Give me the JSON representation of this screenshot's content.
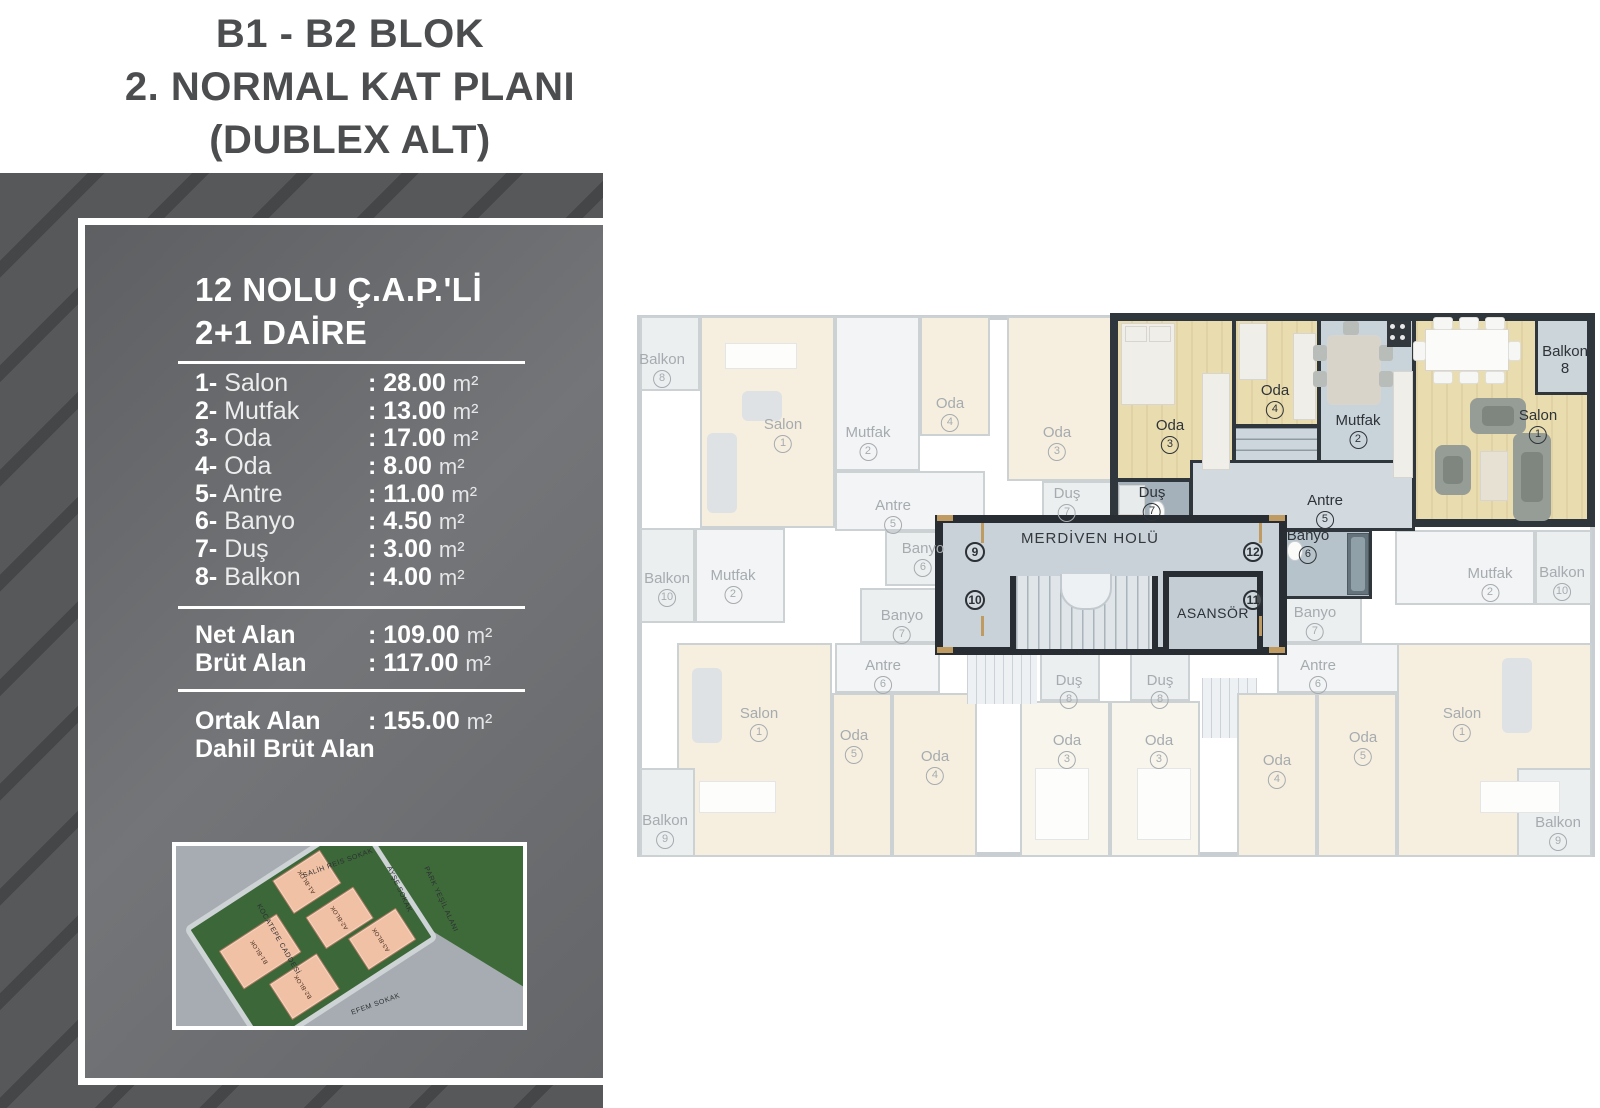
{
  "title": {
    "lines": [
      "B1 - B2 BLOK",
      "2. NORMAL KAT PLANI",
      "(DUBLEX ALT)"
    ]
  },
  "panel": {
    "heading_line1": "12 NOLU Ç.A.P.'Lİ",
    "heading_line2": "2+1 DAİRE",
    "rooms": [
      {
        "no": "1-",
        "name": "Salon",
        "value": ": 28.00",
        "unit": "m²"
      },
      {
        "no": "2-",
        "name": "Mutfak",
        "value": ": 13.00",
        "unit": "m²"
      },
      {
        "no": "3-",
        "name": "Oda",
        "value": ": 17.00",
        "unit": "m²"
      },
      {
        "no": "4-",
        "name": "Oda",
        "value": ": 8.00",
        "unit": "m²"
      },
      {
        "no": "5-",
        "name": "Antre",
        "value": ": 11.00",
        "unit": "m²"
      },
      {
        "no": "6-",
        "name": "Banyo",
        "value": ": 4.50",
        "unit": "m²"
      },
      {
        "no": "7-",
        "name": "Duş",
        "value": ": 3.00",
        "unit": "m²"
      },
      {
        "no": "8-",
        "name": "Balkon",
        "value": ": 4.00",
        "unit": "m²"
      }
    ],
    "areas": [
      {
        "label": "Net Alan",
        "value": ": 109.00",
        "unit": "m²"
      },
      {
        "label": "Brüt Alan",
        "value": ": 117.00",
        "unit": "m²"
      }
    ],
    "common_area": {
      "label_line1": "Ortak Alan",
      "label_line2": "Dahil Brüt Alan",
      "value": ": 155.00",
      "unit": "m²"
    }
  },
  "floor_plan": {
    "core": {
      "hall": "MERDİVEN HOLÜ",
      "elevator": "ASANSÖR",
      "numbers": [
        {
          "t": "9",
          "x": 338,
          "y": 239
        },
        {
          "t": "10",
          "x": 338,
          "y": 287
        },
        {
          "t": "12",
          "x": 616,
          "y": 239
        },
        {
          "t": "11",
          "x": 616,
          "y": 287
        }
      ]
    },
    "labels": [
      {
        "name": "Oda",
        "num": "3",
        "x": 533,
        "y": 104,
        "hl": true
      },
      {
        "name": "Oda",
        "num": "4",
        "x": 638,
        "y": 69,
        "hl": true
      },
      {
        "name": "Mutfak",
        "num": "2",
        "x": 721,
        "y": 99,
        "hl": true
      },
      {
        "name": "Salon",
        "num": "1",
        "x": 901,
        "y": 94,
        "hl": true
      },
      {
        "name": "Balkon",
        "num": "8",
        "x": 928,
        "y": 30,
        "hl": true,
        "plain": true
      },
      {
        "name": "Duş",
        "num": "7",
        "x": 515,
        "y": 171,
        "hl": true
      },
      {
        "name": "Antre",
        "num": "5",
        "x": 688,
        "y": 179,
        "hl": true
      },
      {
        "name": "Banyo",
        "num": "6",
        "x": 671,
        "y": 214,
        "hl": true
      },
      {
        "name": "Balkon",
        "num": "8",
        "x": 25,
        "y": 38
      },
      {
        "name": "Salon",
        "num": "1",
        "x": 146,
        "y": 103
      },
      {
        "name": "Mutfak",
        "num": "2",
        "x": 231,
        "y": 111
      },
      {
        "name": "Oda",
        "num": "4",
        "x": 313,
        "y": 82
      },
      {
        "name": "Oda",
        "num": "3",
        "x": 420,
        "y": 111
      },
      {
        "name": "Duş",
        "num": "7",
        "x": 430,
        "y": 172
      },
      {
        "name": "Antre",
        "num": "5",
        "x": 256,
        "y": 184
      },
      {
        "name": "Banyo",
        "num": "6",
        "x": 286,
        "y": 227
      },
      {
        "name": "Balkon",
        "num": "10",
        "x": 30,
        "y": 257
      },
      {
        "name": "Mutfak",
        "num": "2",
        "x": 96,
        "y": 254
      },
      {
        "name": "Banyo",
        "num": "7",
        "x": 265,
        "y": 294
      },
      {
        "name": "Antre",
        "num": "6",
        "x": 246,
        "y": 344
      },
      {
        "name": "Salon",
        "num": "1",
        "x": 122,
        "y": 392
      },
      {
        "name": "Oda",
        "num": "5",
        "x": 217,
        "y": 414
      },
      {
        "name": "Oda",
        "num": "4",
        "x": 298,
        "y": 435
      },
      {
        "name": "Balkon",
        "num": "9",
        "x": 28,
        "y": 499
      },
      {
        "name": "Duş",
        "num": "8",
        "x": 432,
        "y": 359
      },
      {
        "name": "Duş",
        "num": "8",
        "x": 523,
        "y": 359
      },
      {
        "name": "Oda",
        "num": "3",
        "x": 430,
        "y": 419
      },
      {
        "name": "Oda",
        "num": "3",
        "x": 522,
        "y": 419
      },
      {
        "name": "Mutfak",
        "num": "2",
        "x": 853,
        "y": 252
      },
      {
        "name": "Balkon",
        "num": "10",
        "x": 925,
        "y": 251
      },
      {
        "name": "Banyo",
        "num": "7",
        "x": 678,
        "y": 291
      },
      {
        "name": "Antre",
        "num": "6",
        "x": 681,
        "y": 344
      },
      {
        "name": "Salon",
        "num": "1",
        "x": 825,
        "y": 392
      },
      {
        "name": "Oda",
        "num": "5",
        "x": 726,
        "y": 416
      },
      {
        "name": "Oda",
        "num": "4",
        "x": 640,
        "y": 439
      },
      {
        "name": "Balkon",
        "num": "9",
        "x": 921,
        "y": 501
      }
    ]
  },
  "site_plan": {
    "streets": [
      {
        "t": "SALİH REİS SOKAK",
        "x": 36,
        "y": 8,
        "rot": -20
      },
      {
        "t": "KOCATEPE CADDESİ",
        "x": 18,
        "y": 50,
        "rot": 60
      },
      {
        "t": "AYŞE SOKAK",
        "x": 57,
        "y": 22,
        "rot": 65
      },
      {
        "t": "PARK YEŞİL ALANI",
        "x": 66,
        "y": 28,
        "rot": 65
      },
      {
        "t": "EFEM SOKAK",
        "x": 50,
        "y": 86,
        "rot": -20
      }
    ],
    "blocks": [
      {
        "t": "B1-BLOK",
        "x": 6,
        "y": 24,
        "w": 34,
        "h": 32
      },
      {
        "t": "A1-BLOK",
        "x": 48,
        "y": 2,
        "w": 28,
        "h": 28
      },
      {
        "t": "A2-BLOK",
        "x": 52,
        "y": 38,
        "w": 28,
        "h": 26
      },
      {
        "t": "A3-BLOK",
        "x": 64,
        "y": 68,
        "w": 28,
        "h": 26
      },
      {
        "t": "B2-BLOK",
        "x": 18,
        "y": 64,
        "w": 28,
        "h": 30
      }
    ]
  }
}
